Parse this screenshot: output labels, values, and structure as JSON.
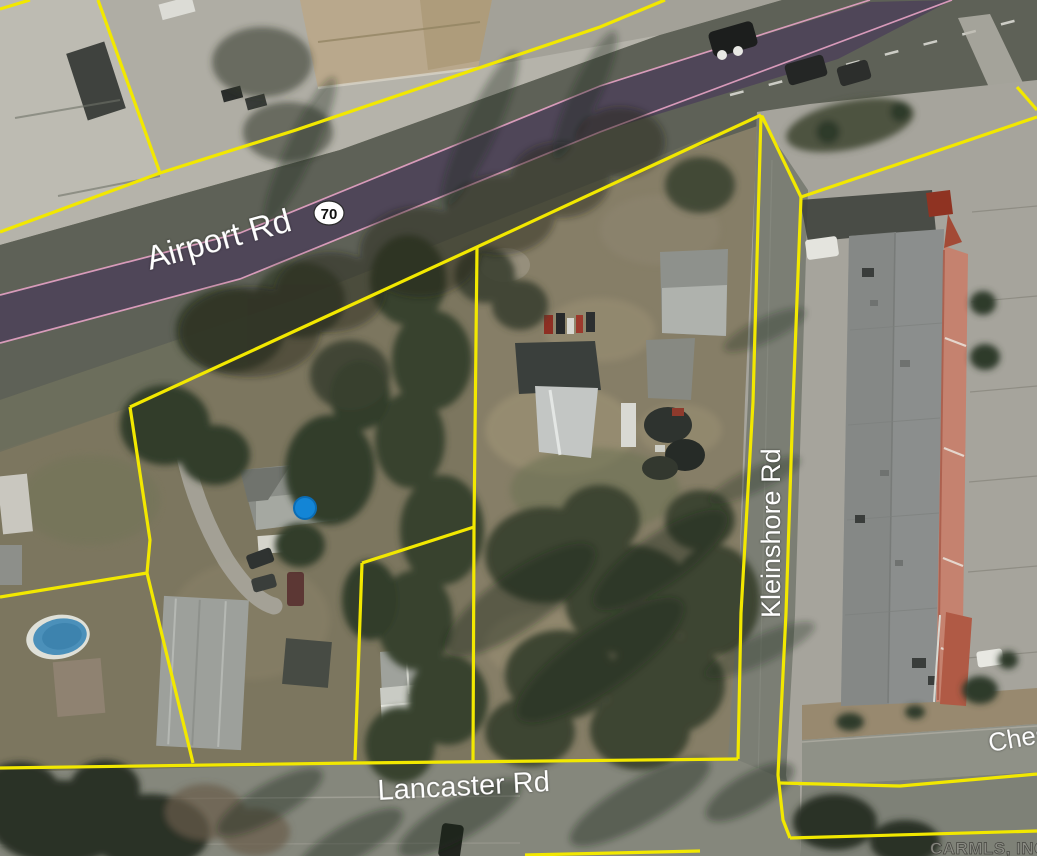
{
  "map": {
    "labels": {
      "airport_rd": "Airport Rd",
      "highway_shield": "70",
      "kleinshore_rd": "Kleinshore Rd",
      "lancaster_rd": "Lancaster Rd",
      "chestnut_partial": "Ches",
      "watermark": "CARMLS, INC"
    },
    "marker": {
      "description": "blue selected-property dot",
      "x": 305,
      "y": 508
    },
    "colors": {
      "parcel-yellow": "#f2e800",
      "highway-purple": "#4c4258",
      "highway-pink": "#df9fc0",
      "marker-blue": "#1385d6",
      "label-white": "#ffffff"
    }
  }
}
